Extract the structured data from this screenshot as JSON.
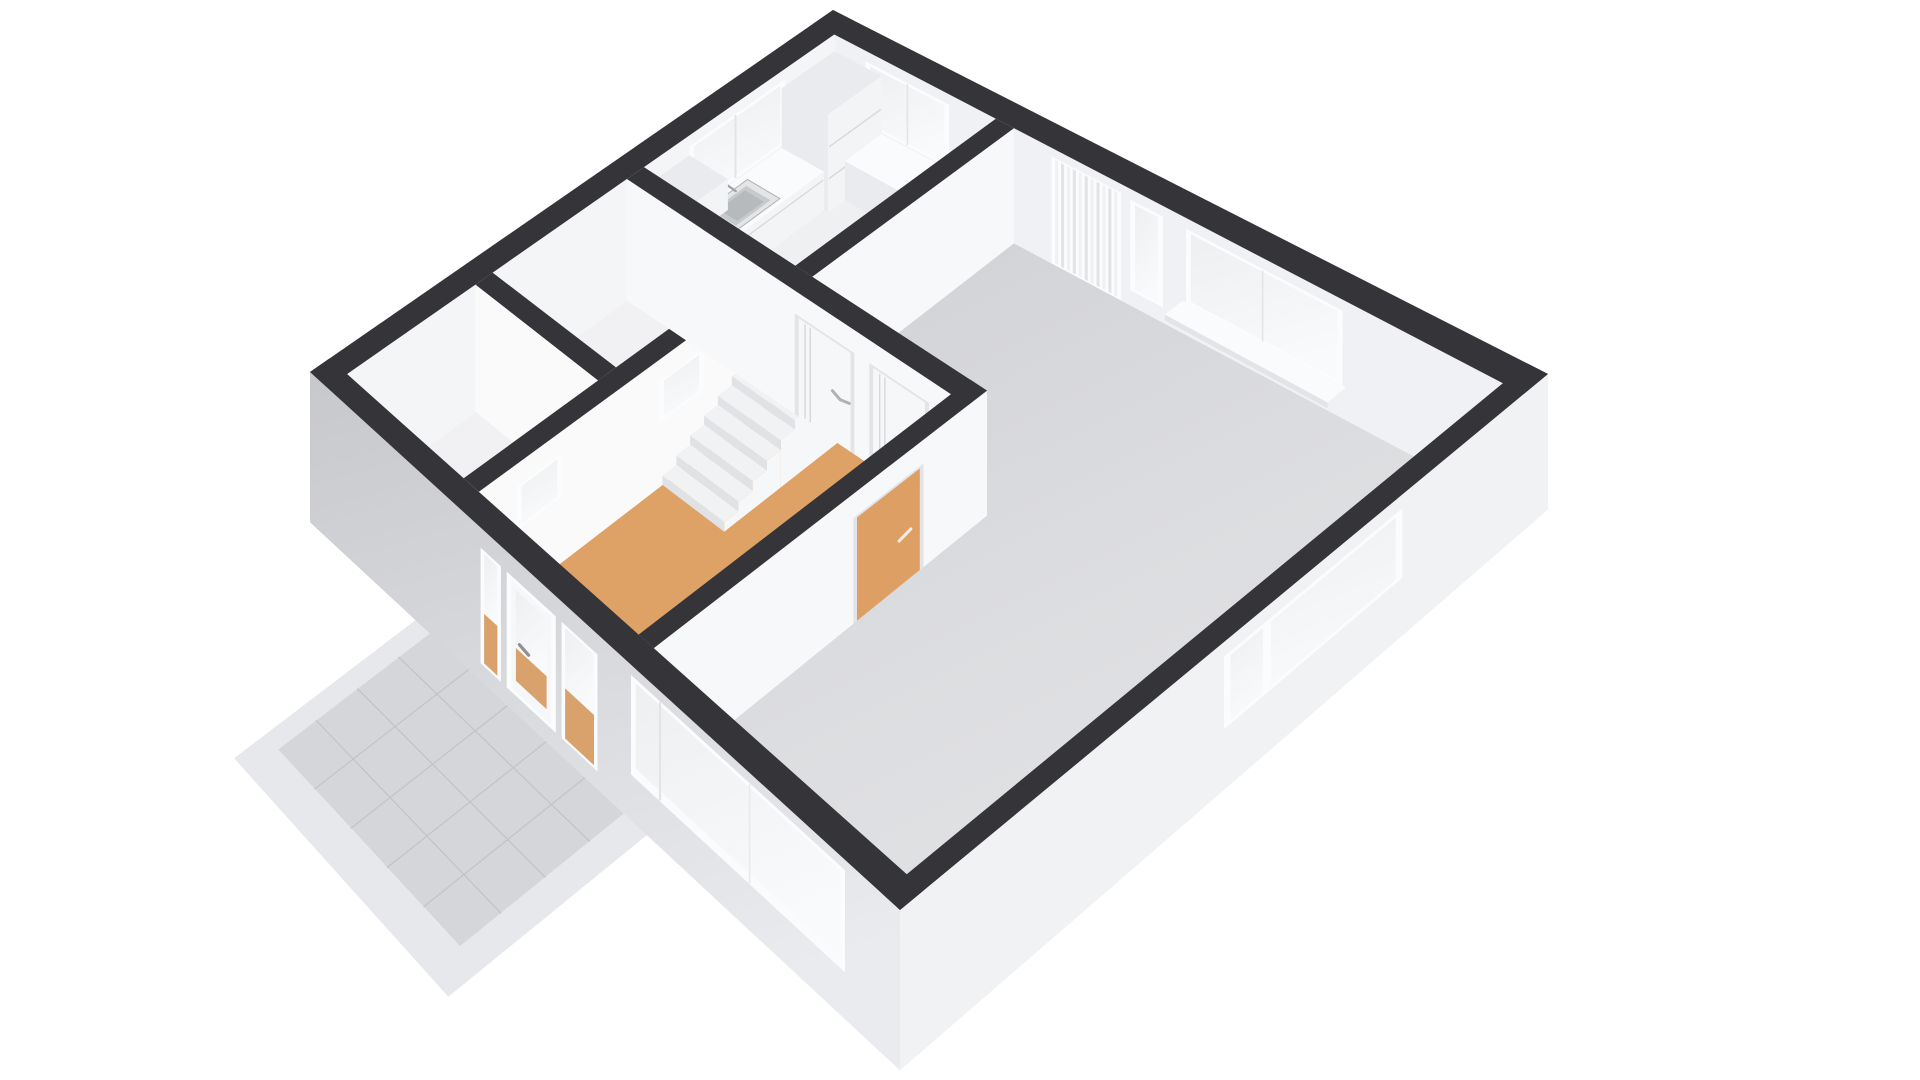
{
  "title": "3D floor plan render - ground floor",
  "view": "axonometric-3d",
  "background": "#ffffff",
  "rooms": [
    {
      "id": "living-room",
      "name": "Living room",
      "floor": "#d8d9dc"
    },
    {
      "id": "kitchen",
      "name": "Kitchen",
      "floor": "#eff0f2"
    },
    {
      "id": "hallway",
      "name": "Hallway / entry",
      "floor": "#dfa266"
    },
    {
      "id": "toilet",
      "name": "Toilet",
      "floor": "#f1f1f3"
    },
    {
      "id": "storage",
      "name": "Storage",
      "floor": "#f1f1f3"
    },
    {
      "id": "staircase",
      "name": "Staircase with landing",
      "steps": 8
    },
    {
      "id": "stairwell-void",
      "name": "Stairwell void opening"
    },
    {
      "id": "terrace",
      "name": "Front terrace (tiled)"
    }
  ],
  "features": [
    "front-door",
    "door-sidelight-left",
    "door-sidelight-right",
    "living-window-sw",
    "se-window",
    "ne-window-large",
    "ne-window-narrow",
    "vertical-blind-door",
    "kitchen-window-nw",
    "kitchen-window-ne",
    "kitchen-counter",
    "kitchen-sink",
    "kitchen-faucet",
    "cooktop",
    "tall-cabinet",
    "upper-cabinet",
    "base-cabinet-return",
    "interior-door-1",
    "interior-door-2",
    "living-room-door-orange",
    "partition-window-1",
    "partition-window-2"
  ],
  "palette": {
    "cap": "#353539",
    "capInner": "#3a3a3f",
    "wallWhite": "#f7f8fa",
    "nwFace": "#f4f5f7",
    "neFace": "#f0f1f4",
    "partitionFace": "#fafafb",
    "exSE": "#f1f2f4",
    "exSWdark": "#c9cacd",
    "exSWlight": "#e9eaed",
    "floorLiving": "#d8d9dc",
    "floorLivingLight": "#e3e4e6",
    "floorKitchen": "#eff0f2",
    "floorRoom": "#f1f1f3",
    "wood": "#dfa266",
    "terrace": "#d5d6d9",
    "terraceLine": "#c2c3c7",
    "terraceOuter": "#e7e8eb",
    "glass": "#eef0f2",
    "glassBright": "#f8fafb",
    "frame": "#fbfcfd",
    "frameShade": "#e2e4e7",
    "doorWhite": "#f6f7f9",
    "seam": "#d6d8db",
    "handle": "#aeb1b5",
    "orange": "#dd9f64",
    "cooktop": "#1d1d21",
    "burner": "#4d4e54",
    "sinkRim": "#e3e5e7",
    "sinkBasin": "#c7cacd",
    "sinkDeep": "#b7babd",
    "metal": "#9aa0a4",
    "tread": "#f1f2f4",
    "riser": "#e0e2e5",
    "stringer": "#f6f7f9",
    "shaft": "#f3f4f6",
    "cabinet": "#f3f4f6",
    "cabinetSide": "#e9ebee",
    "sill": "#fafbfc"
  }
}
